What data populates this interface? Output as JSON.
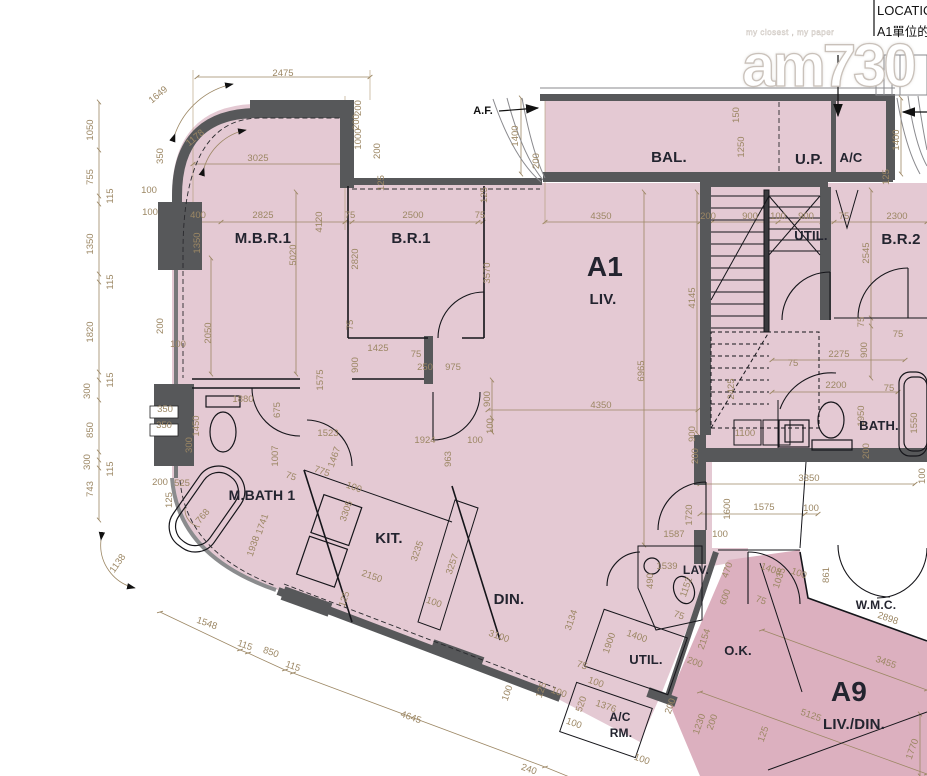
{
  "header": {
    "line1": "LOCATIO",
    "line2": "A1單位的"
  },
  "watermark": {
    "brand": "am730",
    "tagline": "my closest , my paper"
  },
  "colors": {
    "unit_a1": "#e4c9d3",
    "unit_a9": "#dcb0bf",
    "wall": "#57585a",
    "dim_text": "#9c8764",
    "room_text": "#23242f"
  },
  "annotations": [
    {
      "t": "A.F.",
      "x": 483,
      "y": 114
    }
  ],
  "rooms": [
    {
      "label": "M.B.R.1",
      "x": 263,
      "y": 243,
      "s": 15
    },
    {
      "label": "B.R.1",
      "x": 411,
      "y": 243,
      "s": 15
    },
    {
      "label": "A1",
      "x": 605,
      "y": 276,
      "s": 28
    },
    {
      "label": "LIV.",
      "x": 603,
      "y": 304,
      "s": 15
    },
    {
      "label": "BAL.",
      "x": 669,
      "y": 162,
      "s": 15
    },
    {
      "label": "U.P.",
      "x": 809,
      "y": 164,
      "s": 15
    },
    {
      "label": "A/C",
      "x": 851,
      "y": 162,
      "s": 13
    },
    {
      "label": "UTIL.",
      "x": 811,
      "y": 240,
      "s": 13
    },
    {
      "label": "B.R.2",
      "x": 901,
      "y": 244,
      "s": 15
    },
    {
      "label": "BATH.",
      "x": 879,
      "y": 430,
      "s": 13
    },
    {
      "label": "M.BATH 1",
      "x": 262,
      "y": 500,
      "s": 14
    },
    {
      "label": "KIT.",
      "x": 389,
      "y": 543,
      "s": 15
    },
    {
      "label": "DIN.",
      "x": 509,
      "y": 604,
      "s": 15
    },
    {
      "label": "LAV.",
      "x": 696,
      "y": 574,
      "s": 12
    },
    {
      "label": "UTIL.",
      "x": 646,
      "y": 664,
      "s": 13
    },
    {
      "label": "O.K.",
      "x": 738,
      "y": 655,
      "s": 13
    },
    {
      "label": "A/C",
      "x": 620,
      "y": 721,
      "s": 12
    },
    {
      "label": "RM.",
      "x": 621,
      "y": 737,
      "s": 12
    },
    {
      "label": "W.M.C.",
      "x": 876,
      "y": 609,
      "s": 12
    },
    {
      "label": "A9",
      "x": 849,
      "y": 701,
      "s": 28
    },
    {
      "label": "LIV./DIN.",
      "x": 854,
      "y": 729,
      "s": 15
    }
  ],
  "dims": [
    {
      "t": "2475",
      "x": 283,
      "y": 76
    },
    {
      "t": "1649",
      "x": 160,
      "y": 97,
      "r": -40
    },
    {
      "t": "1178",
      "x": 197,
      "y": 140,
      "r": -40
    },
    {
      "t": "3025",
      "x": 258,
      "y": 161
    },
    {
      "t": "350",
      "x": 163,
      "y": 156,
      "r": -90
    },
    {
      "t": "1050",
      "x": 93,
      "y": 130,
      "r": -90
    },
    {
      "t": "755",
      "x": 93,
      "y": 177,
      "r": -90
    },
    {
      "t": "115",
      "x": 113,
      "y": 196,
      "r": -90
    },
    {
      "t": "1350",
      "x": 93,
      "y": 244,
      "r": -90
    },
    {
      "t": "115",
      "x": 113,
      "y": 282,
      "r": -90
    },
    {
      "t": "1820",
      "x": 93,
      "y": 332,
      "r": -90
    },
    {
      "t": "115",
      "x": 113,
      "y": 380,
      "r": -90
    },
    {
      "t": "300",
      "x": 90,
      "y": 391,
      "r": -90
    },
    {
      "t": "850",
      "x": 93,
      "y": 430,
      "r": -90
    },
    {
      "t": "300",
      "x": 90,
      "y": 462,
      "r": -90
    },
    {
      "t": "115",
      "x": 113,
      "y": 469,
      "r": -90
    },
    {
      "t": "743",
      "x": 93,
      "y": 489,
      "r": -90
    },
    {
      "t": "100",
      "x": 149,
      "y": 193
    },
    {
      "t": "100",
      "x": 150,
      "y": 215
    },
    {
      "t": "400",
      "x": 198,
      "y": 218
    },
    {
      "t": "2825",
      "x": 263,
      "y": 218
    },
    {
      "t": "1350",
      "x": 200,
      "y": 243,
      "r": -90
    },
    {
      "t": "4120",
      "x": 322,
      "y": 222,
      "r": -90
    },
    {
      "t": "5020",
      "x": 296,
      "y": 255,
      "r": -90
    },
    {
      "t": "75",
      "x": 350,
      "y": 218
    },
    {
      "t": "2500",
      "x": 413,
      "y": 218
    },
    {
      "t": "75",
      "x": 480,
      "y": 218
    },
    {
      "t": "2820",
      "x": 358,
      "y": 259,
      "r": -90
    },
    {
      "t": "3570",
      "x": 490,
      "y": 273,
      "r": -90
    },
    {
      "t": "125",
      "x": 384,
      "y": 183,
      "r": -90
    },
    {
      "t": "125",
      "x": 487,
      "y": 195,
      "r": -90
    },
    {
      "t": "200",
      "x": 361,
      "y": 108,
      "r": -90
    },
    {
      "t": "200",
      "x": 359,
      "y": 122,
      "r": -90
    },
    {
      "t": "1000",
      "x": 361,
      "y": 139,
      "r": -90
    },
    {
      "t": "200",
      "x": 380,
      "y": 151,
      "r": -90
    },
    {
      "t": "1400",
      "x": 518,
      "y": 136,
      "r": -90
    },
    {
      "t": "200",
      "x": 539,
      "y": 161,
      "r": -90
    },
    {
      "t": "150",
      "x": 739,
      "y": 115,
      "r": -90
    },
    {
      "t": "1250",
      "x": 744,
      "y": 147,
      "r": -90
    },
    {
      "t": "1400",
      "x": 899,
      "y": 140,
      "r": -90
    },
    {
      "t": "125",
      "x": 889,
      "y": 177,
      "r": -90
    },
    {
      "t": "4350",
      "x": 601,
      "y": 219
    },
    {
      "t": "200",
      "x": 708,
      "y": 219
    },
    {
      "t": "900",
      "x": 750,
      "y": 219
    },
    {
      "t": "100",
      "x": 778,
      "y": 219
    },
    {
      "t": "900",
      "x": 806,
      "y": 219
    },
    {
      "t": "75",
      "x": 844,
      "y": 219
    },
    {
      "t": "2300",
      "x": 897,
      "y": 219
    },
    {
      "t": "2545",
      "x": 869,
      "y": 253,
      "r": -90
    },
    {
      "t": "4145",
      "x": 695,
      "y": 298,
      "r": -90
    },
    {
      "t": "2425",
      "x": 734,
      "y": 389,
      "r": -90
    },
    {
      "t": "2275",
      "x": 839,
      "y": 357
    },
    {
      "t": "2200",
      "x": 836,
      "y": 388
    },
    {
      "t": "75",
      "x": 864,
      "y": 322,
      "r": -90
    },
    {
      "t": "900",
      "x": 867,
      "y": 350,
      "r": -90
    },
    {
      "t": "75",
      "x": 898,
      "y": 337
    },
    {
      "t": "6965",
      "x": 644,
      "y": 371,
      "r": -90
    },
    {
      "t": "4350",
      "x": 601,
      "y": 408
    },
    {
      "t": "900",
      "x": 490,
      "y": 399,
      "r": -90
    },
    {
      "t": "100",
      "x": 493,
      "y": 426,
      "r": -90
    },
    {
      "t": "900",
      "x": 695,
      "y": 434,
      "r": -90
    },
    {
      "t": "1100",
      "x": 745,
      "y": 436
    },
    {
      "t": "75",
      "x": 793,
      "y": 366
    },
    {
      "t": "200",
      "x": 698,
      "y": 456,
      "r": -90
    },
    {
      "t": "1950",
      "x": 864,
      "y": 416,
      "r": -90
    },
    {
      "t": "200",
      "x": 869,
      "y": 451,
      "r": -90
    },
    {
      "t": "75",
      "x": 889,
      "y": 391
    },
    {
      "t": "1550",
      "x": 917,
      "y": 423,
      "r": -90
    },
    {
      "t": "100",
      "x": 925,
      "y": 476,
      "r": -90
    },
    {
      "t": "3350",
      "x": 809,
      "y": 481
    },
    {
      "t": "1575",
      "x": 764,
      "y": 510
    },
    {
      "t": "100",
      "x": 811,
      "y": 511
    },
    {
      "t": "1600",
      "x": 730,
      "y": 509,
      "r": -90
    },
    {
      "t": "1720",
      "x": 692,
      "y": 515,
      "r": -90
    },
    {
      "t": "1587",
      "x": 674,
      "y": 537
    },
    {
      "t": "100",
      "x": 720,
      "y": 537
    },
    {
      "t": "2050",
      "x": 211,
      "y": 333,
      "r": -90
    },
    {
      "t": "1575",
      "x": 323,
      "y": 380,
      "r": -90
    },
    {
      "t": "75",
      "x": 353,
      "y": 325,
      "r": -90
    },
    {
      "t": "900",
      "x": 358,
      "y": 365,
      "r": -90
    },
    {
      "t": "675",
      "x": 280,
      "y": 410,
      "r": -90
    },
    {
      "t": "1425",
      "x": 378,
      "y": 351
    },
    {
      "t": "75",
      "x": 416,
      "y": 357
    },
    {
      "t": "250",
      "x": 425,
      "y": 370
    },
    {
      "t": "975",
      "x": 453,
      "y": 370
    },
    {
      "t": "1880",
      "x": 243,
      "y": 402
    },
    {
      "t": "1450",
      "x": 199,
      "y": 426,
      "r": -90
    },
    {
      "t": "300",
      "x": 192,
      "y": 445,
      "r": -90
    },
    {
      "t": "350",
      "x": 165,
      "y": 412
    },
    {
      "t": "350",
      "x": 164,
      "y": 428
    },
    {
      "t": "200",
      "x": 163,
      "y": 326,
      "r": -90
    },
    {
      "t": "100",
      "x": 178,
      "y": 347
    },
    {
      "t": "200",
      "x": 160,
      "y": 485
    },
    {
      "t": "525",
      "x": 182,
      "y": 486
    },
    {
      "t": "125",
      "x": 172,
      "y": 500,
      "r": -90
    },
    {
      "t": "768",
      "x": 205,
      "y": 518,
      "r": -50
    },
    {
      "t": "1007",
      "x": 278,
      "y": 456,
      "r": -90
    },
    {
      "t": "775",
      "x": 321,
      "y": 474,
      "r": 19
    },
    {
      "t": "75",
      "x": 290,
      "y": 479,
      "r": 19
    },
    {
      "t": "1523",
      "x": 328,
      "y": 436
    },
    {
      "t": "1467",
      "x": 337,
      "y": 458,
      "r": -71
    },
    {
      "t": "100",
      "x": 353,
      "y": 490,
      "r": 19
    },
    {
      "t": "3305",
      "x": 349,
      "y": 512,
      "r": -71
    },
    {
      "t": "1924",
      "x": 425,
      "y": 443
    },
    {
      "t": "963",
      "x": 451,
      "y": 459,
      "r": -90
    },
    {
      "t": "100",
      "x": 475,
      "y": 443
    },
    {
      "t": "1741",
      "x": 265,
      "y": 525,
      "r": -71
    },
    {
      "t": "1938",
      "x": 256,
      "y": 547,
      "r": -71
    },
    {
      "t": "2150",
      "x": 371,
      "y": 579,
      "r": 19
    },
    {
      "t": "3235",
      "x": 420,
      "y": 552,
      "r": -71
    },
    {
      "t": "3257",
      "x": 455,
      "y": 565,
      "r": -71
    },
    {
      "t": "125",
      "x": 347,
      "y": 600,
      "r": -71
    },
    {
      "t": "100",
      "x": 433,
      "y": 605,
      "r": 19
    },
    {
      "t": "1548",
      "x": 206,
      "y": 626,
      "r": 19
    },
    {
      "t": "115",
      "x": 244,
      "y": 648,
      "r": 19
    },
    {
      "t": "850",
      "x": 270,
      "y": 655,
      "r": 19
    },
    {
      "t": "115",
      "x": 292,
      "y": 669,
      "r": 19
    },
    {
      "t": "4645",
      "x": 410,
      "y": 720,
      "r": 19
    },
    {
      "t": "240",
      "x": 528,
      "y": 772,
      "r": 19
    },
    {
      "t": "3100",
      "x": 498,
      "y": 639,
      "r": 19
    },
    {
      "t": "3134",
      "x": 574,
      "y": 621,
      "r": -71
    },
    {
      "t": "125",
      "x": 544,
      "y": 691,
      "r": -71
    },
    {
      "t": "100",
      "x": 558,
      "y": 695,
      "r": 19
    },
    {
      "t": "100",
      "x": 510,
      "y": 694,
      "r": -71
    },
    {
      "t": "1900",
      "x": 612,
      "y": 644,
      "r": -71
    },
    {
      "t": "1400",
      "x": 636,
      "y": 639,
      "r": 19
    },
    {
      "t": "75",
      "x": 581,
      "y": 668,
      "r": 19
    },
    {
      "t": "100",
      "x": 595,
      "y": 685,
      "r": 19
    },
    {
      "t": "520",
      "x": 584,
      "y": 705,
      "r": -71
    },
    {
      "t": "1376",
      "x": 605,
      "y": 709,
      "r": 19
    },
    {
      "t": "100",
      "x": 573,
      "y": 726,
      "r": 19
    },
    {
      "t": "100",
      "x": 641,
      "y": 762,
      "r": 19
    },
    {
      "t": "1230",
      "x": 702,
      "y": 725,
      "r": -71
    },
    {
      "t": "200",
      "x": 715,
      "y": 723,
      "r": -71
    },
    {
      "t": "1539",
      "x": 667,
      "y": 569
    },
    {
      "t": "490",
      "x": 653,
      "y": 581,
      "r": -90
    },
    {
      "t": "1152",
      "x": 689,
      "y": 588,
      "r": -71
    },
    {
      "t": "470",
      "x": 730,
      "y": 571,
      "r": -71
    },
    {
      "t": "600",
      "x": 728,
      "y": 598,
      "r": -71
    },
    {
      "t": "75",
      "x": 678,
      "y": 618,
      "r": 19
    },
    {
      "t": "200",
      "x": 694,
      "y": 665,
      "r": 19
    },
    {
      "t": "2154",
      "x": 707,
      "y": 640,
      "r": -71
    },
    {
      "t": "200",
      "x": 673,
      "y": 707,
      "r": -71
    },
    {
      "t": "1408",
      "x": 770,
      "y": 572,
      "r": 19
    },
    {
      "t": "1035",
      "x": 782,
      "y": 579,
      "r": -71
    },
    {
      "t": "100",
      "x": 798,
      "y": 576,
      "r": 19
    },
    {
      "t": "861",
      "x": 829,
      "y": 575,
      "r": -90
    },
    {
      "t": "75",
      "x": 760,
      "y": 603,
      "r": 19
    },
    {
      "t": "2898",
      "x": 887,
      "y": 621,
      "r": 19
    },
    {
      "t": "3455",
      "x": 885,
      "y": 665,
      "r": 19
    },
    {
      "t": "5125",
      "x": 810,
      "y": 718,
      "r": 19
    },
    {
      "t": "1770",
      "x": 915,
      "y": 750,
      "r": -71
    },
    {
      "t": "125",
      "x": 766,
      "y": 735,
      "r": -71
    },
    {
      "t": "1138",
      "x": 120,
      "y": 565,
      "r": -55
    }
  ]
}
